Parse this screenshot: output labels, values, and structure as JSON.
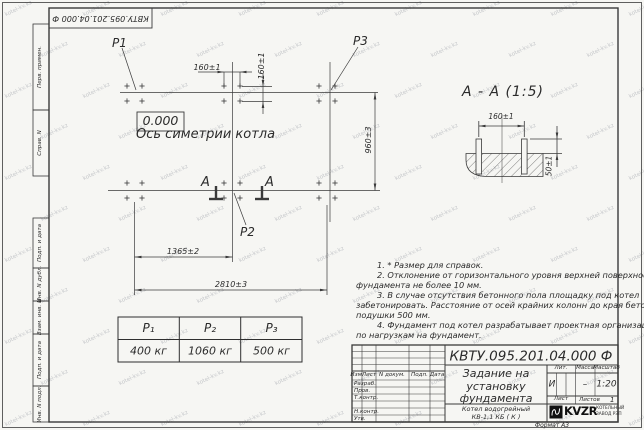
{
  "watermark": {
    "text": "kotel-kv.kz"
  },
  "frame": {
    "doc_number_inverted": "КВТУ.095.201.04.000  Ф",
    "strip_labels": [
      "Перв. примен.",
      "Справ. N",
      "Подп. и дата",
      "Инв. N дубл.",
      "Взам. инв. N",
      "Подп. и дата",
      "Инв. N подл."
    ],
    "format_note": "Формат А3"
  },
  "plan": {
    "point_labels": {
      "p1": "P1",
      "p2": "P2",
      "p3": "P3"
    },
    "elevation": "0.000",
    "axis_caption": "Ось симетрии котла",
    "section_letter_left": "A",
    "section_letter_right": "A",
    "dims": {
      "top_horizontal": "160±1",
      "top_vertical": "160±1",
      "height": "960±3",
      "half_length": "1365±2",
      "full_length": "2810±3"
    }
  },
  "section": {
    "title": "A - A (1:5)",
    "dims": {
      "bolt_spacing": "160±1",
      "protrusion": "50±1"
    }
  },
  "loads_table": {
    "headers": [
      "P₁",
      "P₂",
      "P₃"
    ],
    "values": [
      "400 кг",
      "1060 кг",
      "500 кг"
    ]
  },
  "notes": {
    "lines": [
      "1. * Размер для справок.",
      "2. Отклонение от горизонтального уровня верхней поверхности",
      "фундамента не более 10 мм.",
      "3. В случае отсутствия бетонного пола площадку под котел",
      "забетонировать. Расстояние от осей крайних колонн до края бетонной",
      "подушки 500 мм.",
      "4. Фундамент под котел разрабатывает проектная организация",
      "по нагрузкам на фундамент."
    ]
  },
  "title_block": {
    "doc_number": "КВТУ.095.201.04.000  Ф",
    "title_lines": [
      "Задание на",
      "установку",
      "фундамента"
    ],
    "product_lines": [
      "Котел водогрейный",
      "КВ-1,1 КБ  ( К )"
    ],
    "header_cols": [
      "Изм.",
      "Лист",
      "N докум.",
      "Подп.",
      "Дата"
    ],
    "row_labels": [
      "Разраб.",
      "Пров.",
      "Т.контр.",
      "Н.контр.",
      "Утв."
    ],
    "lit_header": "Лит.",
    "mass_header": "Масса",
    "scale_header": "Масштаб",
    "lit_value": "И",
    "mass_value": "–",
    "scale_value": "1:20",
    "sheet_label": "Лист",
    "sheets_label": "Листов",
    "sheets_value": "1",
    "logo_text": "KVZR",
    "logo_sub1": "КОТЕЛЬНЫЙ",
    "logo_sub2": "ЗАВОД РЭП"
  }
}
